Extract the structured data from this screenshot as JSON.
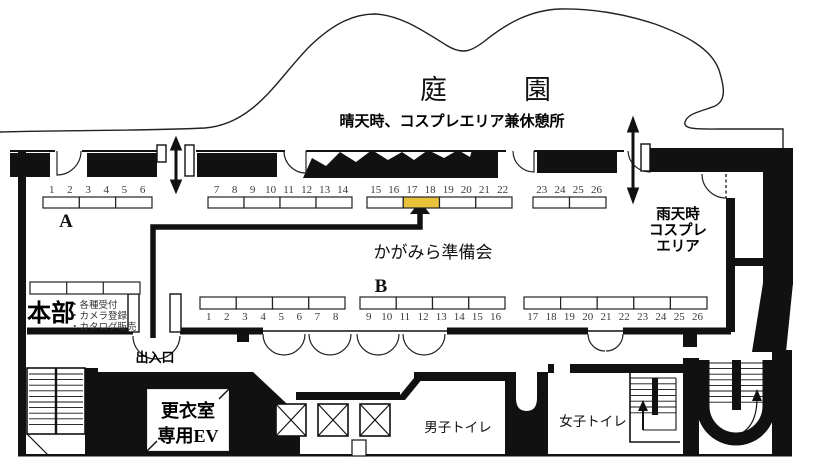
{
  "map": {
    "garden_label": "庭園",
    "sunny_note": "晴天時、コスプレエリア兼休憩所",
    "rain_area_lines": [
      "雨天時",
      "コスプレ",
      "エリア"
    ],
    "organizer_label": "かがみら準備会",
    "hq_label": "本部",
    "hq_services": [
      "・各種受付",
      "・カメラ登録",
      "・カタログ販売"
    ],
    "entrance_label": "出入口",
    "ev_lines": [
      "更衣室",
      "専用EV"
    ],
    "mens_toilet_label": "男子トイレ",
    "womens_toilet_label": "女子トイレ"
  },
  "rows": {
    "a": {
      "label": "A",
      "groups": [
        {
          "cells": [
            [
              1,
              2
            ],
            [
              3,
              4
            ],
            [
              5,
              6
            ]
          ]
        },
        {
          "cells": [
            [
              7,
              8
            ],
            [
              9,
              10
            ],
            [
              11,
              12
            ],
            [
              13,
              14
            ]
          ]
        },
        {
          "cells": [
            [
              15,
              16
            ],
            [
              17,
              18
            ],
            [
              19,
              20
            ],
            [
              21,
              22
            ]
          ],
          "highlight_cell": 1
        },
        {
          "cells": [
            [
              23,
              24
            ],
            [
              25,
              26
            ]
          ]
        }
      ]
    },
    "b": {
      "label": "B",
      "groups": [
        {
          "cells": [
            [
              1,
              2
            ],
            [
              3,
              4
            ],
            [
              5,
              6
            ],
            [
              7,
              8
            ]
          ]
        },
        {
          "cells": [
            [
              9,
              10
            ],
            [
              11,
              12
            ],
            [
              13,
              14
            ],
            [
              15,
              16
            ]
          ]
        },
        {
          "cells": [
            [
              17,
              18
            ],
            [
              19,
              20
            ],
            [
              21,
              22
            ],
            [
              23,
              24
            ],
            [
              25,
              26
            ]
          ]
        }
      ]
    }
  },
  "colors": {
    "highlight": "#e8c23a",
    "wall": "#111111"
  }
}
